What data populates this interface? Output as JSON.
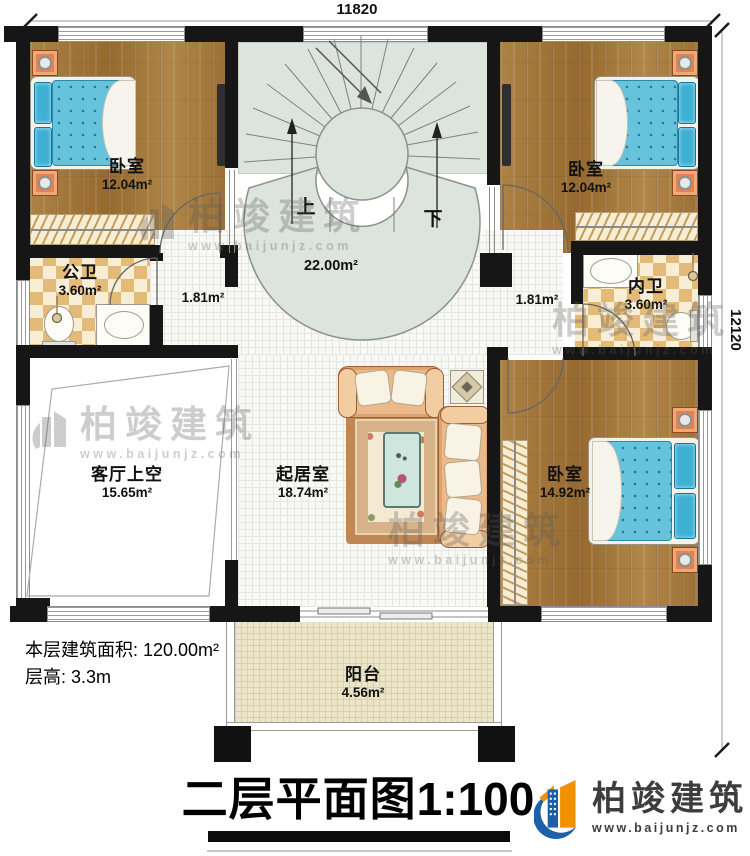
{
  "dimensions": {
    "top": "11820",
    "right": "12120"
  },
  "stairs": {
    "up": "上",
    "down": "下",
    "area": "22.00m²"
  },
  "rooms": {
    "bedroom_tl": {
      "name": "卧室",
      "area": "12.04m²"
    },
    "bedroom_tr": {
      "name": "卧室",
      "area": "12.04m²"
    },
    "bedroom_br": {
      "name": "卧室",
      "area": "14.92m²"
    },
    "public_bath": {
      "name": "公卫",
      "area": "3.60m²"
    },
    "private_bath": {
      "name": "内卫",
      "area": "3.60m²"
    },
    "hall_left": {
      "area": "1.81m²"
    },
    "hall_right": {
      "area": "1.81m²"
    },
    "living_void": {
      "name": "客厅上空",
      "area": "15.65m²"
    },
    "living": {
      "name": "起居室",
      "area": "18.74m²"
    },
    "balcony": {
      "name": "阳台",
      "area": "4.56m²"
    }
  },
  "info": {
    "floor_area": "本层建筑面积: 120.00m²",
    "floor_height": "层高: 3.3m"
  },
  "title": {
    "name": "二层平面图",
    "scale": "1:100"
  },
  "brand": {
    "name": "柏竣建筑",
    "url": "www.baijunjz.com"
  },
  "watermark": {
    "name": "柏竣建筑",
    "url": "www.baijunjz.com"
  },
  "colors": {
    "wall": "#161616",
    "wood_floor": "#a67a3e",
    "bath_tile": "#e4ba79",
    "stair_bg": "#dde3dd",
    "balcony_floor": "#ebe5ca",
    "mattress_blue": "#67c3dc",
    "brand_blue": "#1d5fa8",
    "brand_orange": "#f29100"
  }
}
